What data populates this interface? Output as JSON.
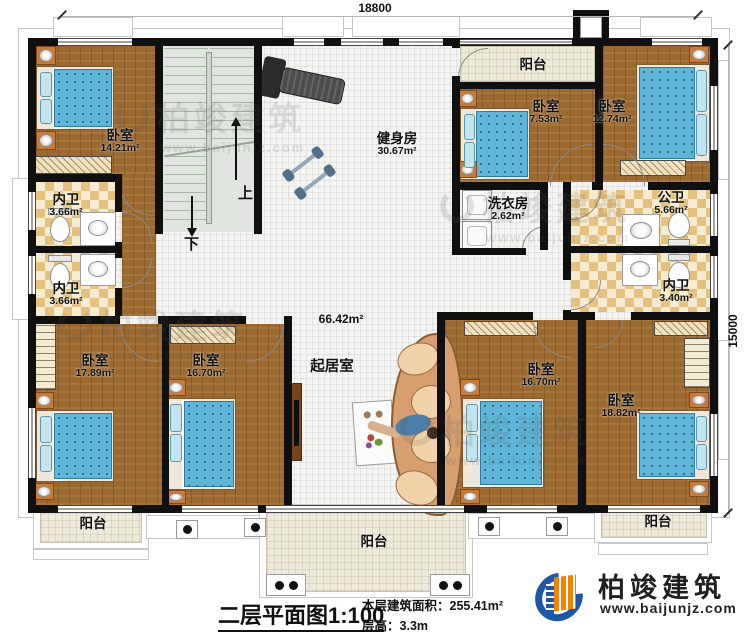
{
  "dimensions": {
    "width": "18800",
    "height": "15000"
  },
  "stairs": {
    "up": "上",
    "down": "下"
  },
  "rooms": {
    "bedroom_tl": {
      "name": "卧室",
      "area": "14.21m²"
    },
    "bath_l1": {
      "name": "内卫",
      "area": "3.66m²"
    },
    "bath_l2": {
      "name": "内卫",
      "area": "3.66m²"
    },
    "gym": {
      "name": "健身房",
      "area": "30.67m²"
    },
    "balcony_top": {
      "name": "阳台"
    },
    "bedroom_t2": {
      "name": "卧室",
      "area": "7.53m²"
    },
    "bedroom_t3": {
      "name": "卧室",
      "area": "12.74m²"
    },
    "laundry": {
      "name": "洗衣房",
      "area": "2.62m²"
    },
    "bath_public": {
      "name": "公卫",
      "area": "5.66m²"
    },
    "bath_r": {
      "name": "内卫",
      "area": "3.40m²"
    },
    "living": {
      "name": "起居室",
      "area": "66.42m²"
    },
    "bedroom_b1": {
      "name": "卧室",
      "area": "17.89m²"
    },
    "bedroom_b2": {
      "name": "卧室",
      "area": "16.70m²"
    },
    "bedroom_b3": {
      "name": "卧室",
      "area": "16.70m²"
    },
    "bedroom_b4": {
      "name": "卧室",
      "area": "18.82m²"
    },
    "balcony_bl": {
      "name": "阳台"
    },
    "balcony_bc": {
      "name": "阳台"
    },
    "balcony_br": {
      "name": "阳台"
    }
  },
  "title": {
    "text": "二层平面图",
    "scale": "1:100"
  },
  "info": {
    "area_label": "本层建筑面积：",
    "area_value": "255.41m²",
    "height_label": "层高：",
    "height_value": "3.3m"
  },
  "brand": {
    "name": "柏竣建筑",
    "url": "www.baijunjz.com"
  },
  "watermark": {
    "name": "柏竣建筑",
    "url": "www.baijunjz.com"
  },
  "colors": {
    "wall": "#101010",
    "wood": "#9c6a30",
    "tile": "#f4f4f2",
    "checker": "#e4c27e",
    "balcony": "#eeeada",
    "stair": "#e0e6df",
    "bed": "#5fb6d9",
    "sofa": "#d79f6f",
    "brand_blue": "#1e57a5",
    "brand_orange": "#f08300"
  }
}
